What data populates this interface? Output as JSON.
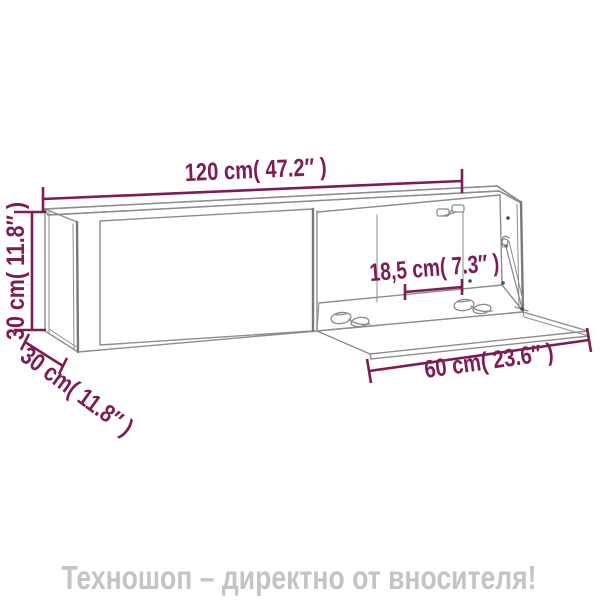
{
  "diagram": {
    "title_semantic": "wall-cabinet-dimension-diagram",
    "labels": {
      "width": "120 cm( 47.2″ )",
      "height": "30 cm( 11.8″ )",
      "depth": "30 cm( 11.8″ )",
      "inner_width": "18,5 cm( 7.3″ )",
      "flap_depth": "60 cm( 23.6″ )"
    },
    "colors": {
      "dimension": "#7d1c55",
      "line": "#8d8d8d",
      "line-heavy": "#787878",
      "caption": "#c4c4c4",
      "background": "#ffffff"
    }
  },
  "footer": {
    "caption": "Техношоп – директно от вносителя!"
  }
}
